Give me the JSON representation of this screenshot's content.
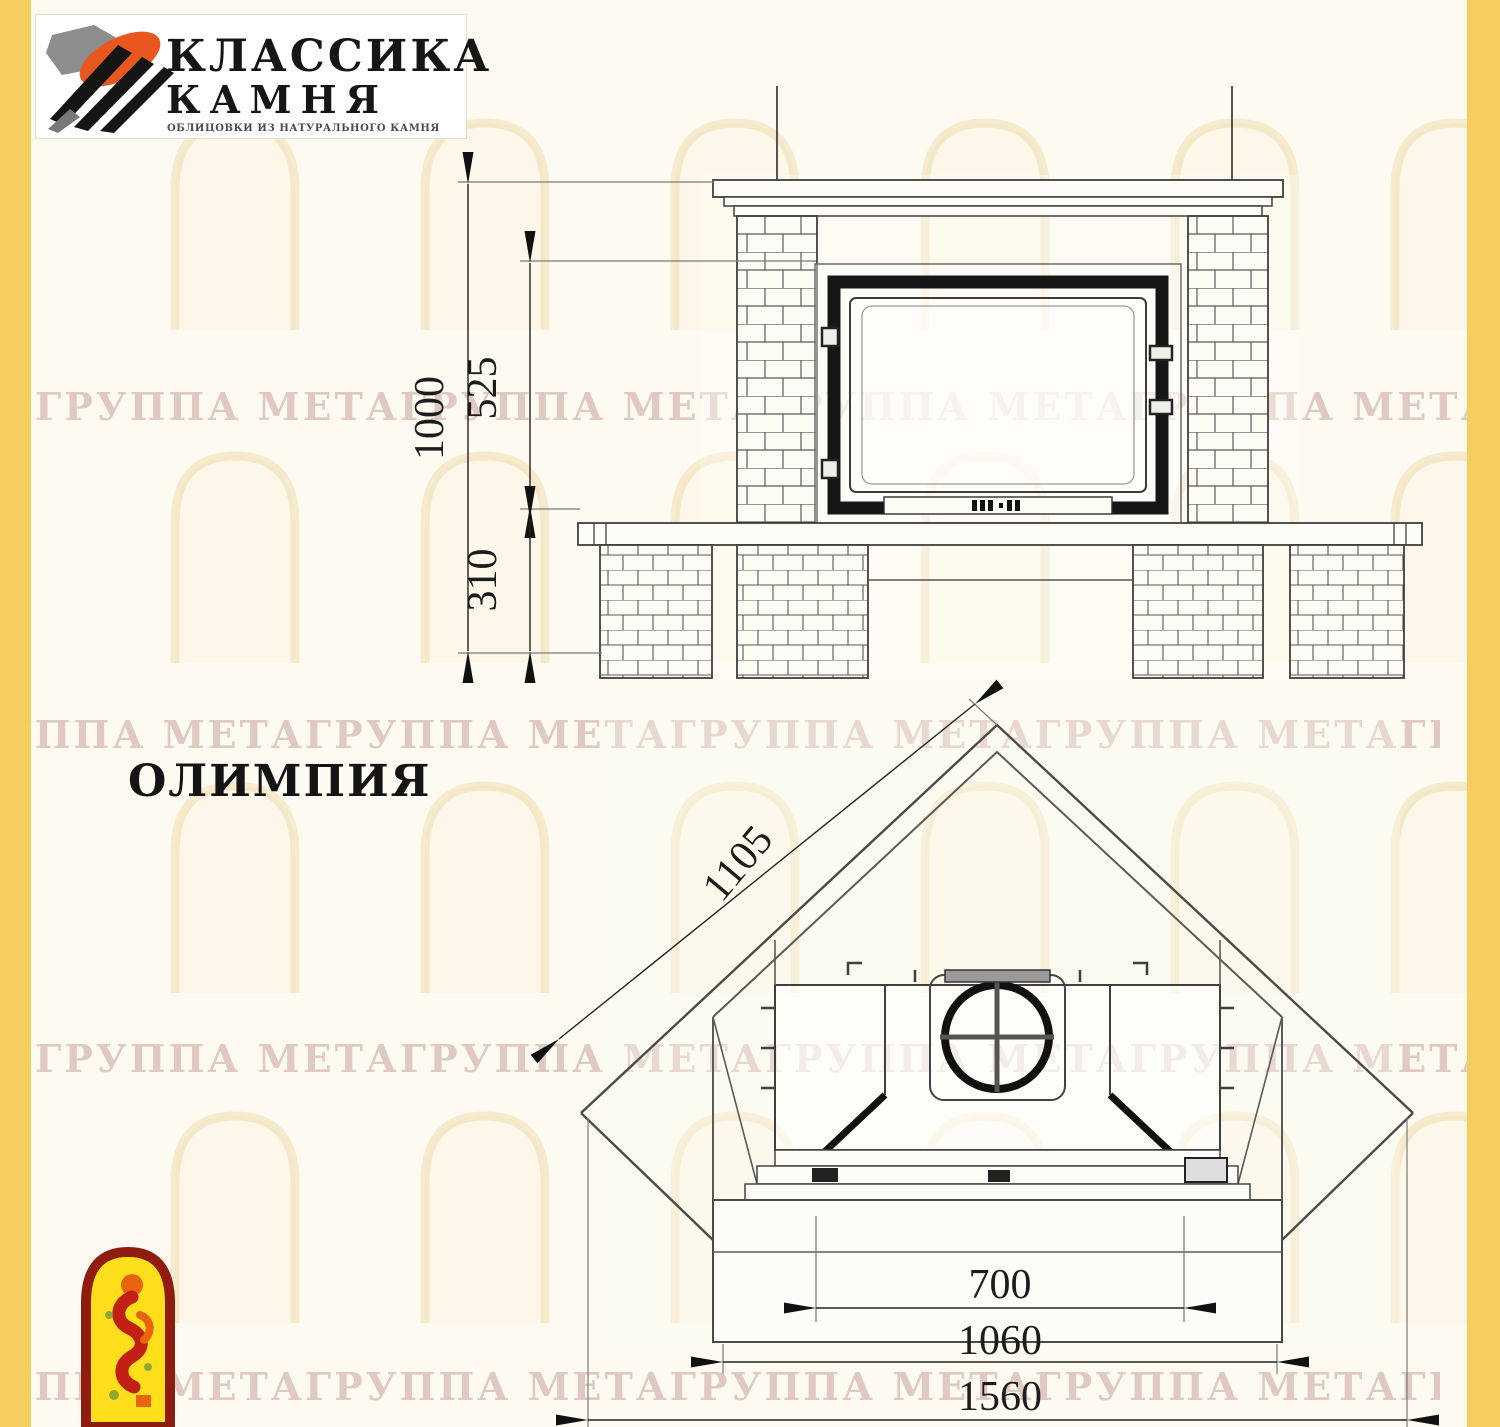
{
  "page": {
    "model_title": "ОЛИМПИЯ"
  },
  "logo": {
    "title_line1": "КЛАССИКА",
    "title_line2": "КАМНЯ",
    "tagline": "ОБЛИЦОВКИ ИЗ НАТУРАЛЬНОГО КАМНЯ"
  },
  "watermark": {
    "text": "ГРУППА МЕТАГРУППА МЕТАГРУППА МЕТАГРУППА МЕТАГРУППА МЕТА"
  },
  "front_view": {
    "dims": {
      "total_height": "1000",
      "firebox_height": "525",
      "base_height": "310"
    }
  },
  "plan_view": {
    "dims": {
      "side_depth": "1105",
      "firebox_width": "700",
      "bench_width": "1060",
      "total_width": "1560"
    }
  },
  "colors": {
    "edge_yellow": "#F6CE60",
    "logo_orange": "#E8571D",
    "icon_border_red": "#8E1D10",
    "icon_fill_yellow": "#FFDE1C"
  }
}
